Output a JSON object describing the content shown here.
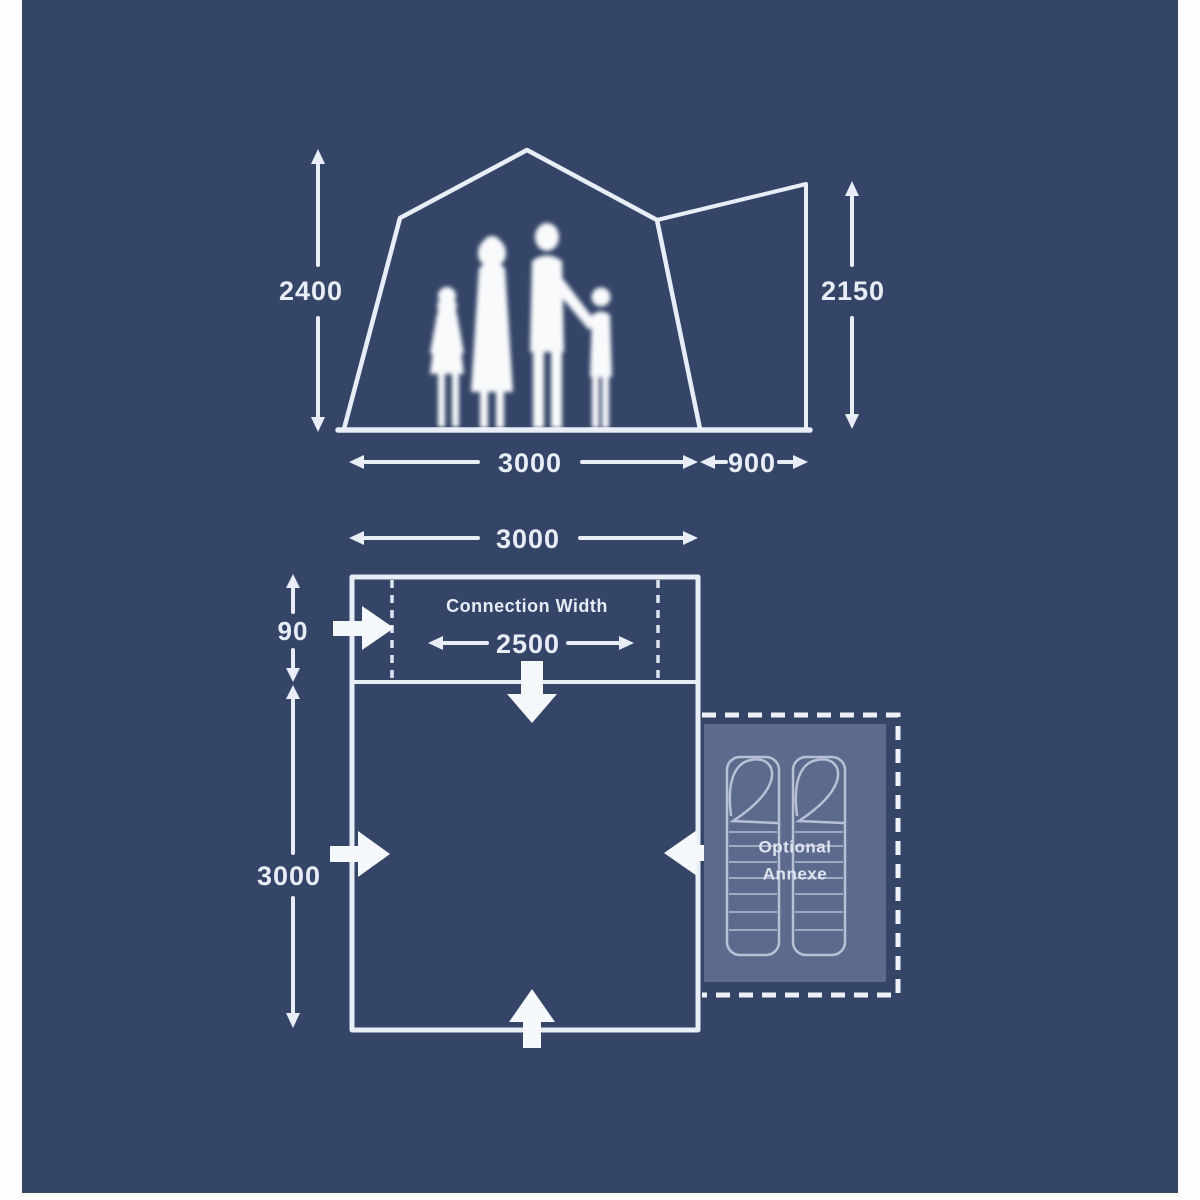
{
  "meta": {
    "page_bg": "#fdfdfe",
    "panel_bg": "#344568",
    "line_color": "#e9edf6",
    "annexe_fill": "#5b6a8d",
    "bag_line_color": "#b7c0d5"
  },
  "elevation": {
    "left_height": "2400",
    "right_height": "2150",
    "main_width": "3000",
    "annex_width": "900"
  },
  "floorplan": {
    "top_width": "3000",
    "connection_title": "Connection Width",
    "connection_width": "2500",
    "connection_depth": "90",
    "side_depth": "3000",
    "annexe_line1": "Optional",
    "annexe_line2": "Annexe"
  }
}
